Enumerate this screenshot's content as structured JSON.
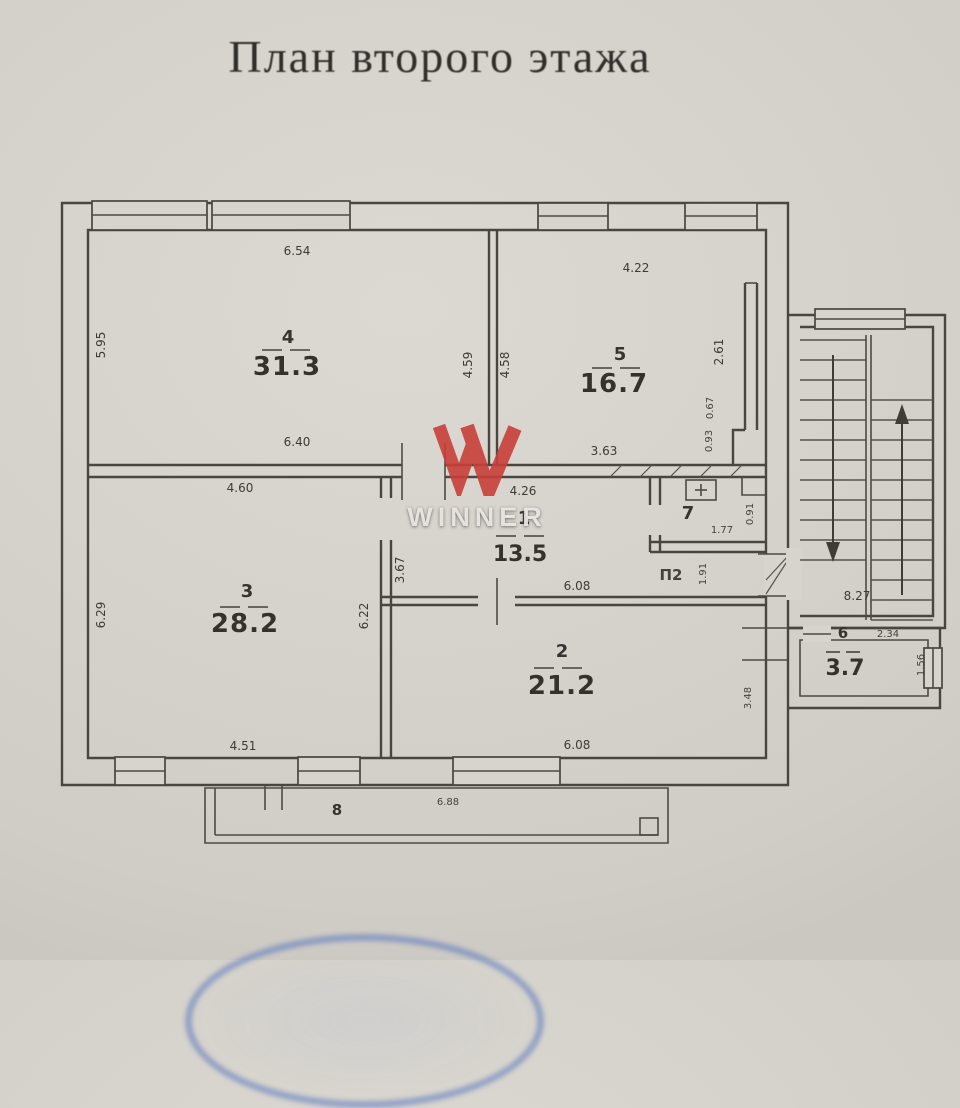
{
  "title": "План второго этажа",
  "watermark": {
    "brand": "WINNER",
    "logo_color": "#c8403a"
  },
  "rooms": {
    "r1": {
      "num": "1",
      "area": "13.5"
    },
    "r2": {
      "num": "2",
      "area": "21.2"
    },
    "r3": {
      "num": "3",
      "area": "28.2"
    },
    "r4": {
      "num": "4",
      "area": "31.3"
    },
    "r5": {
      "num": "5",
      "area": "16.7"
    },
    "r6": {
      "num": "6",
      "area": "3.7"
    },
    "r7": {
      "num": "7",
      "area": "1.77"
    },
    "r8": {
      "num": "8"
    }
  },
  "labels": {
    "hatch_opening": "П2"
  },
  "dims": {
    "room4_top": "6.54",
    "room4_bottom": "6.40",
    "room4_left": "5.95",
    "room5_top": "4.22",
    "room5_bottom": "3.63",
    "divider45_left": "4.59",
    "divider45_right": "4.58",
    "shaft_top": "2.61",
    "shaft_mid": "0.67",
    "shaft_bottom": "0.93",
    "room3_top": "4.60",
    "room3_bottom": "4.51",
    "room3_left": "6.29",
    "room3_right": "6.22",
    "room1_top": "4.26",
    "room1_left": "3.67",
    "room1_bottom": "6.08",
    "room2_bottom": "6.08",
    "room2_right": "3.48",
    "room7_side": "0.91",
    "hatch_width": "1.91",
    "stairs_depth": "8.27",
    "room6_top": "2.34",
    "room6_right": "1.56",
    "balcony": "6.88"
  }
}
